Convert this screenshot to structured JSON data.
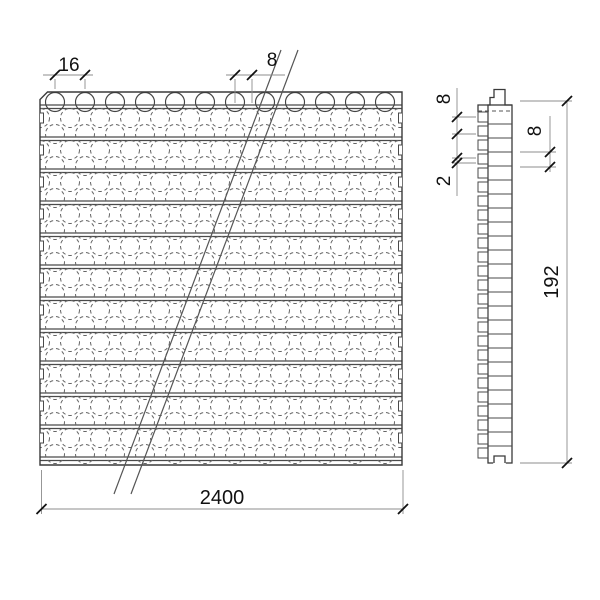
{
  "drawing": {
    "front_view": {
      "dim_knob_pitch": "16",
      "dim_knob_offset": "8",
      "dim_length": "2400"
    },
    "side_view": {
      "dim_knob_height": "8",
      "dim_web": "2",
      "dim_rib_pitch": "8",
      "dim_height": "192"
    },
    "colors": {
      "line": "#3a3a3a",
      "pattern": "#666666",
      "dimension": "#8c8c8c",
      "text": "#111111",
      "background": "#ffffff"
    }
  }
}
